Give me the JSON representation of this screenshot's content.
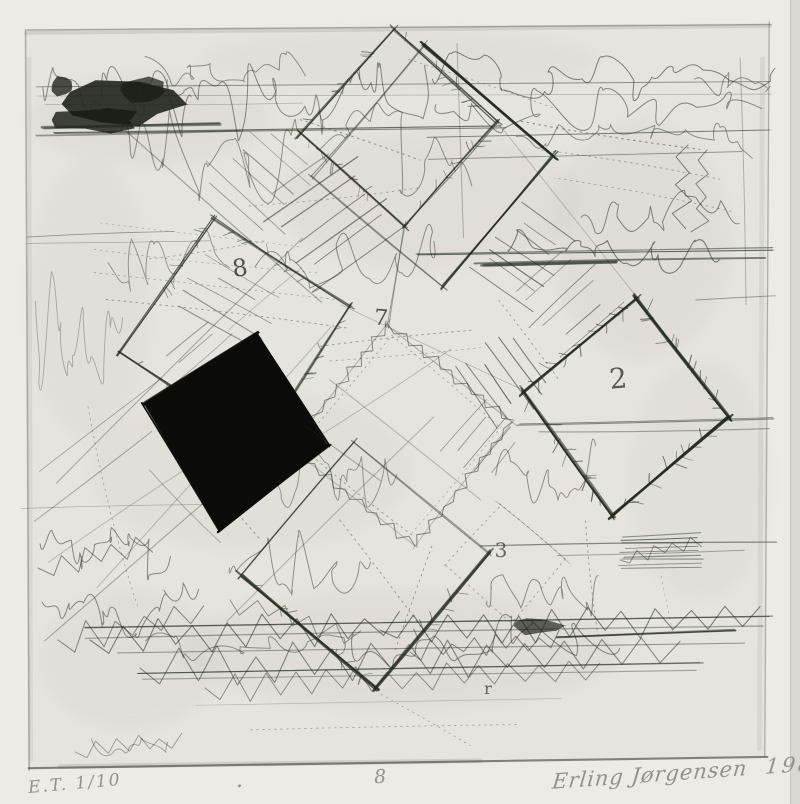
{
  "artwork": {
    "plate_marks": {
      "square_number": "8",
      "center_number": "7",
      "diamond_number": "2",
      "lower_number": "3",
      "bottom_letter": "r"
    },
    "inscriptions": {
      "edition": "E.T. 1/10",
      "dot": ".",
      "plate_number": "8",
      "signature": "Erling Jørgensen",
      "year": "1988"
    },
    "colors": {
      "paper": "#ecebe6",
      "plate": "#e6e4de",
      "ink": "#222b1d",
      "black_square": "#0b0b09",
      "pencil": "#92928b"
    }
  }
}
